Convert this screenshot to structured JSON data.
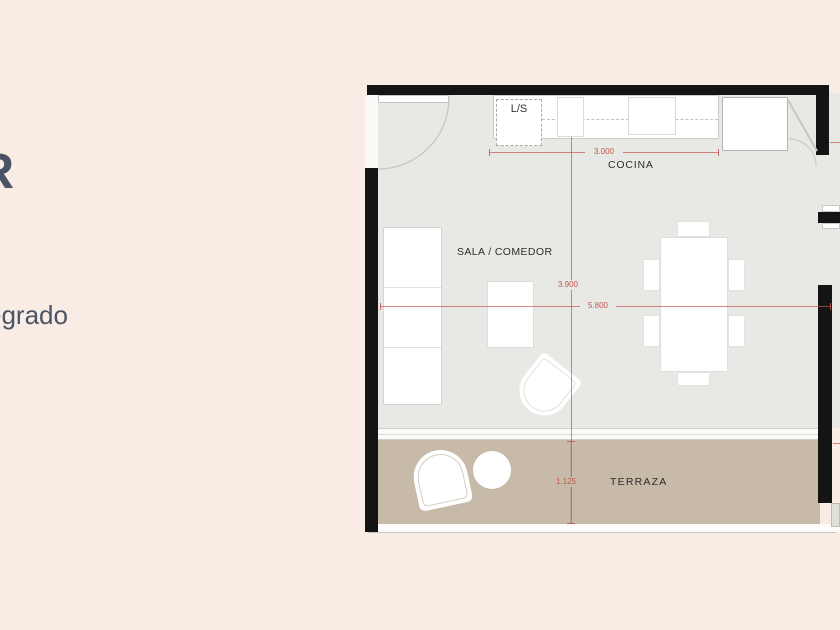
{
  "fragments": {
    "title": "R",
    "subtitle": "egrado"
  },
  "labels": {
    "cocina": "COCINA",
    "sala": "SALA / COMEDOR",
    "terraza": "TERRAZA",
    "laundry": "L/S"
  },
  "dims": {
    "kitchen_width": "3.000",
    "sala_depth": "3.900",
    "sala_width": "5.800",
    "terrace_depth": "1.125"
  },
  "colors": {
    "background": "#f8ece4",
    "floor": "#e8e9e4",
    "terrace": "#c7baa8",
    "wall": "#141414",
    "outline": "#cccccc",
    "red": "#c0564d",
    "text": "#2d2d2d",
    "fragment": "#4b5465"
  }
}
